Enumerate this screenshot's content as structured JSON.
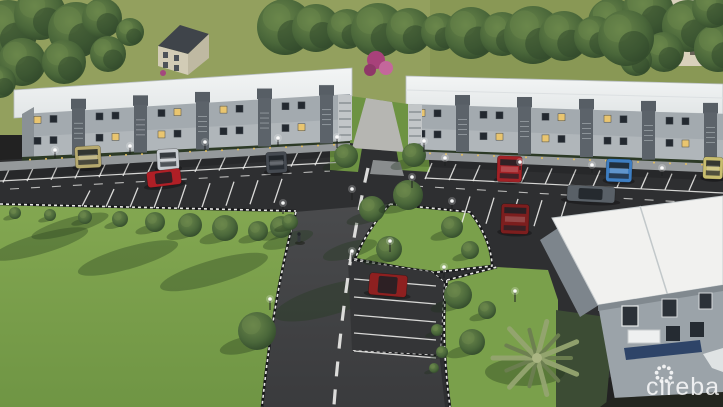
{
  "meta": {
    "type": "architectural-rendering",
    "view": "aerial",
    "subject": "Aerial 3D rendering of a townhouse development: two long two-storey rows with white roofs, front parking lots with cars, a central access road with dashed centre line, landscaped lawns, median islands with trees, a small parking pocket, a palm tree and a clubhouse building",
    "width": 723,
    "height": 407
  },
  "watermark": {
    "text": "cireba",
    "logo": "dotted-flower-ring"
  },
  "colors": {
    "field": "#93a05e",
    "fieldShade": "#81914f",
    "treeDark": "#31492c",
    "treeMid": "#4a673a",
    "treeLight": "#6b874b",
    "lawn": "#7aa04b",
    "lawnDark": "#6d9342",
    "lawnShadow": "#223a1d",
    "asphalt": "#2e2f31",
    "road": "#434446",
    "lineWhite": "#e9e9e7",
    "roofWhite": "#edefef",
    "roofEdge": "#c1c7c9",
    "facade": "#a3aaaf",
    "facadeLower": "#b4babd",
    "facadeDark": "#5c636a",
    "windowDark": "#232930",
    "windowLit": "#e9c56f",
    "sidewalk": "#95999b",
    "hedge": "#2c3a26",
    "clubRoof": "#f1f1ef",
    "clubWall": "#9ba3a9",
    "clubWallShade": "#7d858c",
    "blueBed": "#2e4468",
    "houseRoof": "#3f444a",
    "houseWall": "#d2ccb6",
    "towerWall": "#d9d1bc",
    "palm": "#95a470",
    "palmDark": "#6d7e50",
    "watermark": "#ffffff"
  },
  "scene": {
    "buildings": [
      {
        "name": "townhouse-row-left",
        "floors": 2,
        "roof": "white",
        "facade": "gray"
      },
      {
        "name": "townhouse-row-right",
        "floors": 2,
        "roof": "white",
        "facade": "gray"
      },
      {
        "name": "clubhouse",
        "floors": 2,
        "roof": "white flat",
        "facade": "gray"
      },
      {
        "name": "background-house",
        "floors": 2
      },
      {
        "name": "background-tower",
        "floors": 4
      }
    ],
    "vehicles": [
      {
        "name": "beige-van",
        "color": "#b6a96e"
      },
      {
        "name": "silver-car",
        "color": "#c7cbd0"
      },
      {
        "name": "red-sports-car",
        "color": "#b01f26"
      },
      {
        "name": "dark-gray-car",
        "color": "#454a51"
      },
      {
        "name": "red-sedan",
        "color": "#a32126"
      },
      {
        "name": "blue-car",
        "color": "#3e7ec2"
      },
      {
        "name": "gray-sedan",
        "color": "#596067"
      },
      {
        "name": "dark-red-suv",
        "color": "#7c1e1e"
      },
      {
        "name": "yellow-van",
        "color": "#c8bd6e"
      },
      {
        "name": "red-suv",
        "color": "#8e2020"
      }
    ],
    "landscape": [
      "lawns",
      "street-trees",
      "palm-tree",
      "bougainvillea",
      "tree-shadows"
    ],
    "infrastructure": [
      "parking-bays",
      "drive-lanes",
      "access-road",
      "dashed-centre-line",
      "checkered-curbs",
      "street-lights",
      "pedestrian"
    ]
  }
}
